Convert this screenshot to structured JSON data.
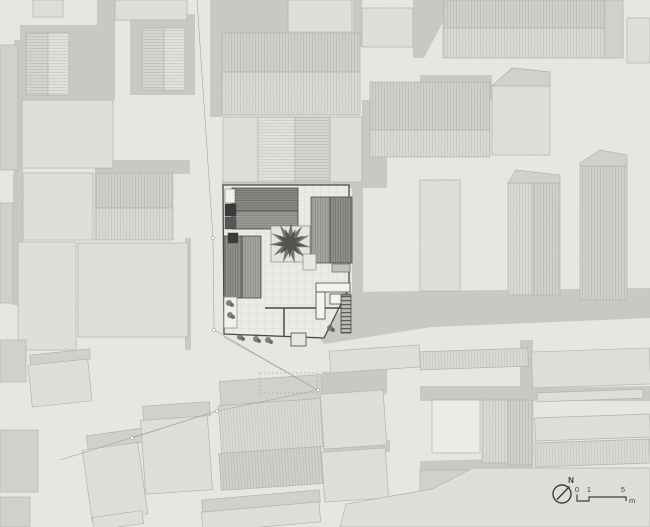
{
  "canvas": {
    "width": 650,
    "height": 527
  },
  "palette": {
    "base_ground": "#e9e8e5",
    "road": "#c9c8c5",
    "building_fill": "#e0dfdc",
    "building_stroke": "#b2b1ae",
    "building_medium": "#d2d1ce",
    "building_white": "#efeeeb",
    "central_roof_dark": "#8f8e8b",
    "central_roof_light": "#a3a2a0",
    "courtyard": "#eceae7",
    "tree_canopy": "#61615c",
    "ink": "#3f3e3c",
    "survey_line": "#a3a29f"
  },
  "legend": {
    "north_label": "N",
    "tick_0": "0",
    "tick_1": "1",
    "tick_5": "5",
    "unit": "m"
  },
  "site": {
    "roads": [
      {
        "points": "210,0 288,0 288,33 222,33 222,117 210,117"
      },
      {
        "points": "353,0 362,0 362,47 353,47"
      },
      {
        "points": "413,0 443,0 443,22 424,58 413,58"
      },
      {
        "points": "420,75 492,75 492,100 420,100"
      },
      {
        "points": "362,100 387,100 387,182 362,182"
      },
      {
        "points": "222,180 387,180 387,188 222,188"
      },
      {
        "points": "352,187 363,187 363,292 352,292"
      },
      {
        "points": "350,292 650,288 650,318 432,327 324,344 318,336 350,300"
      },
      {
        "points": "520,340 533,340 533,392 520,392"
      },
      {
        "points": "420,386 533,386 533,401 420,401"
      },
      {
        "points": "533,388 650,386 650,401 533,401"
      },
      {
        "points": "20,25 115,25 115,100 20,100"
      },
      {
        "points": "97,0 115,0 115,95 97,95"
      },
      {
        "points": "130,14 195,14 195,95 130,95"
      },
      {
        "points": "14,40 23,40 23,173 14,173"
      },
      {
        "points": "13,173 23,173 23,305 13,305"
      },
      {
        "points": "95,160 190,160 190,174 95,174"
      },
      {
        "points": "185,238 191,238 191,350 185,350"
      },
      {
        "points": "322,372 387,368 387,394 322,398"
      },
      {
        "points": "323,444 390,440 390,452 323,456"
      },
      {
        "points": "420,461 533,458 533,470 420,472"
      }
    ],
    "buildings": [
      {
        "x": 26,
        "y": 33,
        "w": 22,
        "h": 62,
        "style": "hh2"
      },
      {
        "x": 48,
        "y": 33,
        "w": 21,
        "h": 62,
        "style": "hh"
      },
      {
        "x": 142,
        "y": 28,
        "w": 22,
        "h": 62,
        "style": "hh2"
      },
      {
        "x": 164,
        "y": 28,
        "w": 21,
        "h": 62,
        "style": "hh"
      },
      {
        "x": 33,
        "y": 0,
        "w": 30,
        "h": 17,
        "style": "plain"
      },
      {
        "x": 115,
        "y": 0,
        "w": 72,
        "h": 20,
        "style": "plain"
      },
      {
        "x": 0,
        "y": 45,
        "w": 18,
        "h": 125,
        "style": "med"
      },
      {
        "x": 22,
        "y": 100,
        "w": 91,
        "h": 68,
        "style": "plain"
      },
      {
        "x": 0,
        "y": 203,
        "w": 13,
        "h": 100,
        "style": "med"
      },
      {
        "x": 23,
        "y": 173,
        "w": 70,
        "h": 67,
        "style": "plain"
      },
      {
        "x": 95,
        "y": 173,
        "w": 78,
        "h": 35,
        "style": "hv2"
      },
      {
        "x": 95,
        "y": 208,
        "w": 78,
        "h": 32,
        "style": "hv"
      },
      {
        "x": 18,
        "y": 242,
        "w": 58,
        "h": 108,
        "style": "plain"
      },
      {
        "x": 78,
        "y": 243,
        "w": 110,
        "h": 94,
        "style": "plain"
      },
      {
        "x": 288,
        "y": 0,
        "w": 64,
        "h": 32,
        "style": "plain"
      },
      {
        "x": 362,
        "y": 8,
        "w": 51,
        "h": 39,
        "style": "plain"
      },
      {
        "x": 222,
        "y": 33,
        "w": 138,
        "h": 39,
        "style": "hv2"
      },
      {
        "x": 222,
        "y": 72,
        "w": 138,
        "h": 43,
        "style": "hv"
      },
      {
        "x": 223,
        "y": 117,
        "w": 35,
        "h": 65,
        "style": "plain"
      },
      {
        "x": 258,
        "y": 117,
        "w": 37,
        "h": 65,
        "style": "hh"
      },
      {
        "x": 295,
        "y": 117,
        "w": 35,
        "h": 65,
        "style": "hh2"
      },
      {
        "x": 330,
        "y": 117,
        "w": 32,
        "h": 65,
        "style": "plain"
      },
      {
        "x": 443,
        "y": 0,
        "w": 165,
        "h": 28,
        "style": "hv2"
      },
      {
        "x": 443,
        "y": 28,
        "w": 165,
        "h": 30,
        "style": "hv"
      },
      {
        "x": 370,
        "y": 82,
        "w": 120,
        "h": 48,
        "style": "hv2"
      },
      {
        "x": 370,
        "y": 130,
        "w": 120,
        "h": 27,
        "style": "hv"
      },
      {
        "x": 605,
        "y": 0,
        "w": 18,
        "h": 58,
        "style": "med"
      },
      {
        "x": 627,
        "y": 18,
        "w": 23,
        "h": 45,
        "style": "plain"
      },
      {
        "x": 420,
        "y": 180,
        "w": 40,
        "h": 111,
        "style": "plain"
      },
      {
        "x": 508,
        "y": 183,
        "w": 25,
        "h": 112,
        "style": "hv"
      },
      {
        "x": 533,
        "y": 183,
        "w": 27,
        "h": 112,
        "style": "hv2"
      },
      {
        "x": 580,
        "y": 166,
        "w": 47,
        "h": 134,
        "style": "hv2"
      },
      {
        "x": 220,
        "y": 378,
        "w": 102,
        "h": 24,
        "style": "med",
        "rot": -4
      },
      {
        "x": 220,
        "y": 402,
        "w": 102,
        "h": 48,
        "style": "hv",
        "rot": -4
      },
      {
        "x": 220,
        "y": 450,
        "w": 102,
        "h": 37,
        "style": "hv2",
        "rot": -4
      },
      {
        "x": 322,
        "y": 392,
        "w": 63,
        "h": 55,
        "style": "plain",
        "rot": -4
      },
      {
        "x": 323,
        "y": 450,
        "w": 64,
        "h": 50,
        "style": "plain",
        "rot": -4
      },
      {
        "x": 330,
        "y": 348,
        "w": 90,
        "h": 22,
        "style": "plain",
        "rot": -4
      },
      {
        "x": 420,
        "y": 350,
        "w": 108,
        "h": 18,
        "style": "hv",
        "rot": -2
      },
      {
        "x": 532,
        "y": 350,
        "w": 118,
        "h": 36,
        "style": "plain",
        "rot": -2
      },
      {
        "x": 432,
        "y": 400,
        "w": 48,
        "h": 53,
        "style": "white"
      },
      {
        "x": 482,
        "y": 400,
        "w": 26,
        "h": 63,
        "style": "hv"
      },
      {
        "x": 508,
        "y": 400,
        "w": 25,
        "h": 65,
        "style": "hv2"
      },
      {
        "x": 537,
        "y": 391,
        "w": 106,
        "h": 9,
        "style": "plain",
        "rot": -2
      },
      {
        "x": 535,
        "y": 416,
        "w": 115,
        "h": 23,
        "style": "plain",
        "rot": -2
      },
      {
        "x": 535,
        "y": 441,
        "w": 115,
        "h": 24,
        "style": "hv",
        "rot": -2
      },
      {
        "x": 420,
        "y": 470,
        "w": 53,
        "h": 43,
        "style": "med"
      },
      {
        "x": 30,
        "y": 352,
        "w": 60,
        "h": 10,
        "style": "med",
        "rot": -6
      },
      {
        "x": 30,
        "y": 362,
        "w": 60,
        "h": 42,
        "style": "plain",
        "rot": -6
      },
      {
        "x": 87,
        "y": 432,
        "w": 56,
        "h": 14,
        "style": "med",
        "rot": -8
      },
      {
        "x": 87,
        "y": 446,
        "w": 56,
        "h": 72,
        "style": "plain",
        "rot": -8
      },
      {
        "x": 143,
        "y": 404,
        "w": 67,
        "h": 14,
        "style": "med",
        "rot": -4
      },
      {
        "x": 143,
        "y": 418,
        "w": 67,
        "h": 74,
        "style": "plain",
        "rot": -4
      },
      {
        "x": 0,
        "y": 340,
        "w": 26,
        "h": 42,
        "style": "med"
      },
      {
        "x": 0,
        "y": 430,
        "w": 38,
        "h": 62,
        "style": "med"
      },
      {
        "x": 0,
        "y": 497,
        "w": 30,
        "h": 30,
        "style": "med"
      },
      {
        "x": 202,
        "y": 495,
        "w": 118,
        "h": 12,
        "style": "med",
        "rot": -5
      },
      {
        "x": 202,
        "y": 507,
        "w": 118,
        "h": 20,
        "style": "plain",
        "rot": -5
      },
      {
        "x": 93,
        "y": 514,
        "w": 50,
        "h": 13,
        "style": "plain",
        "rot": -8
      }
    ],
    "building_polys": [
      {
        "points": "492,86 512,68 550,72 550,155 492,155",
        "style": "plain"
      },
      {
        "points": "492,86 512,68 550,72 550,86",
        "style": "med"
      },
      {
        "points": "508,183 516,170 560,175 560,183",
        "style": "med"
      },
      {
        "points": "580,166 580,163 600,150 627,155 627,166",
        "style": "med"
      },
      {
        "points": "340,527 346,504 432,489 473,468 650,468 650,527",
        "style": "plain"
      }
    ],
    "survey_lines": [
      {
        "points": "197,0 213,238 214,330 318,390"
      },
      {
        "points": "224,337 318,390"
      },
      {
        "points": "318,390 217,411 60,460"
      },
      {
        "points": "217,411 132,438"
      }
    ],
    "survey_nodes": [
      [
        213,
        238
      ],
      [
        214,
        330
      ],
      [
        318,
        390
      ],
      [
        217,
        411
      ],
      [
        132,
        438
      ]
    ],
    "central_plan": {
      "boundary": "223,185 349,185 349,288 324,338 224,334",
      "roofs": [
        {
          "x": 232,
          "y": 188,
          "w": 66,
          "h": 23,
          "style": "chhD"
        },
        {
          "x": 232,
          "y": 211,
          "w": 66,
          "h": 18,
          "style": "chhL"
        },
        {
          "x": 224,
          "y": 236,
          "w": 18,
          "h": 62,
          "style": "chvD"
        },
        {
          "x": 242,
          "y": 236,
          "w": 19,
          "h": 62,
          "style": "chvL"
        },
        {
          "x": 311,
          "y": 197,
          "w": 19,
          "h": 66,
          "style": "chvL"
        },
        {
          "x": 330,
          "y": 197,
          "w": 22,
          "h": 66,
          "style": "chvD"
        }
      ],
      "entry_blocks": [
        {
          "x": 225,
          "y": 189,
          "w": 10,
          "h": 14,
          "fill": "#f2f1ee"
        },
        {
          "x": 225,
          "y": 204,
          "w": 11,
          "h": 12,
          "fill": "#3a3a38"
        },
        {
          "x": 225,
          "y": 217,
          "w": 11,
          "h": 12,
          "fill": "#565654"
        },
        {
          "x": 228,
          "y": 233,
          "w": 10,
          "h": 10,
          "fill": "#3a3a38"
        }
      ],
      "planter": {
        "x": 271,
        "y": 226,
        "w": 39,
        "h": 36
      },
      "tree": {
        "cx": 290,
        "cy": 243,
        "r": 21
      },
      "bench": {
        "x": 303,
        "y": 254,
        "w": 13,
        "h": 16
      },
      "table": {
        "x": 332,
        "y": 264,
        "w": 18,
        "h": 8
      },
      "room": {
        "x": 224,
        "y": 297,
        "w": 13,
        "h": 31
      },
      "sofa": [
        {
          "x": 316,
          "y": 283,
          "w": 34,
          "h": 9
        },
        {
          "x": 316,
          "y": 292,
          "w": 9,
          "h": 27
        },
        {
          "x": 330,
          "y": 294,
          "w": 20,
          "h": 10
        }
      ],
      "stair": {
        "x": 341,
        "y": 295,
        "w": 10,
        "h": 38
      },
      "walls": "M265,308 H342 M284,308 V337",
      "porch": {
        "x": 291,
        "y": 333,
        "w": 15,
        "h": 13
      },
      "plants": [
        [
          229,
          303
        ],
        [
          230,
          315
        ],
        [
          240,
          337
        ],
        [
          256,
          339
        ],
        [
          268,
          340
        ],
        [
          330,
          328
        ]
      ],
      "dashed_rect": {
        "x": 260,
        "y": 373,
        "w": 57,
        "h": 20
      }
    }
  }
}
